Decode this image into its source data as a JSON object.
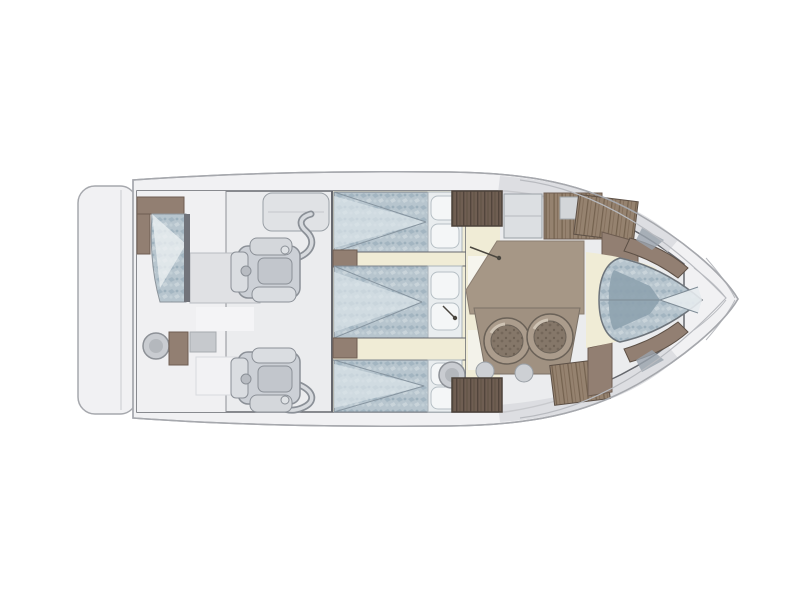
{
  "diagram": {
    "type": "yacht-floor-plan",
    "description": "Top-down interior deck plan of a motor yacht, bow pointing right",
    "areas": [
      "swim platform",
      "aft deck",
      "engine room",
      "guest berth aft",
      "guest berth middle",
      "guest berth forward",
      "companionway",
      "galley",
      "salon",
      "dinette seats",
      "v-berth master cabin",
      "foredeck"
    ]
  },
  "colors": {
    "background": "#ffffff",
    "hull_fill": "#f1f1f3",
    "hull_stroke": "#a6a8ad",
    "interior_fill": "#ebecee",
    "aft_deck_fill": "#f0f0f2",
    "wall_stroke": "#66686e",
    "deck_seam": "#b8babf",
    "side_deck": "#d9dbde",
    "cream_floor": "#f0ecd6",
    "salon_floor": "#a69786",
    "seat_base": "#a09181",
    "wood_mid": "#927f72",
    "wood_dark": "#63544a",
    "bed_texture_base": "#b7c5ce",
    "bed_fold_shadow": "#8ea2af",
    "bed_fold_light": "#dde7eb",
    "pillow": "#f4f6f7",
    "engine_fill": "#ccd0d6",
    "engine_stroke": "#8b9097",
    "seat_ring": "#ab9c8c",
    "seat_center": "#857769",
    "stool": "#c9ccd1",
    "table_gray": "#e0e1e4",
    "door_line": "#4a463f"
  }
}
